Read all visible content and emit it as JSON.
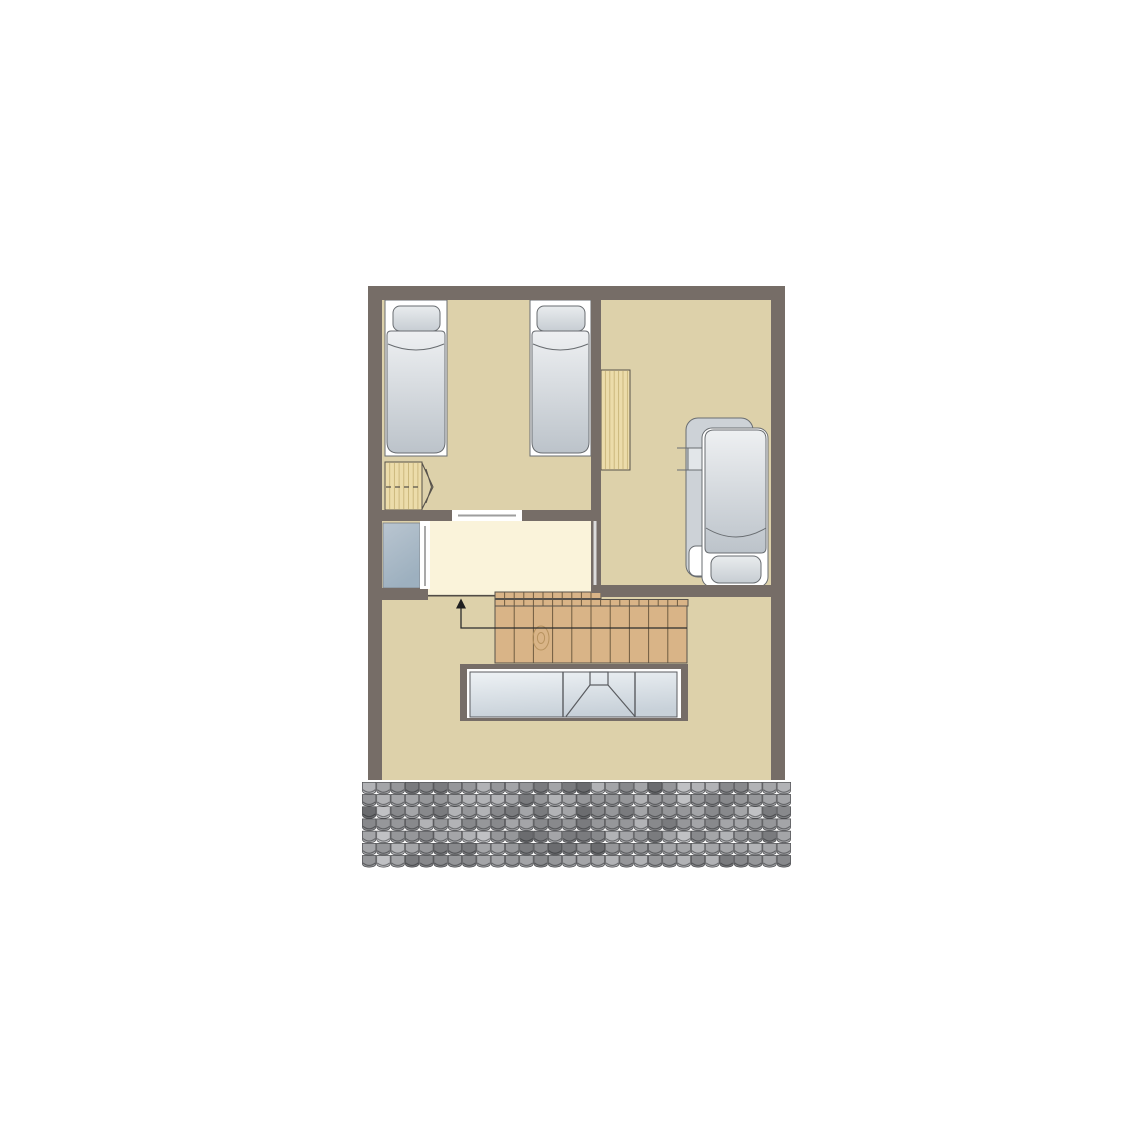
{
  "diagram": {
    "type": "floor-plan",
    "floor": "attic-level",
    "text_labels": []
  },
  "colors": {
    "background": "#ffffff",
    "wall": "#766d67",
    "floor": "#ddd1aa",
    "landing_floor": "#faf3da",
    "bed_recess": "#ffffff",
    "stair_wood": "#d9b487",
    "stair_line": "#6f5c40",
    "light_wood": "#ecdcaa",
    "wood_grain": "#c9b57a",
    "wood_outline": "#57524b",
    "back_bed": "#cdd2d7",
    "shelf_fill": "#e2e6e9",
    "glass_line": "#5a5c60",
    "glass_inset": "#fdfdfd",
    "walk_line": "#2d2d2d",
    "arrow_head": "#1f1f1f",
    "door_line": "#a9a9a9",
    "door_line_light": "#dcdcdc",
    "sliding_door_line": "#9e9e9e",
    "landing_line": "#514c46",
    "knot": "#b8935f",
    "mattress_gradient": [
      "#eef0f2",
      "#bcc3ca"
    ],
    "pillow_gradient": [
      "#e9ecee",
      "#c7cdd3"
    ],
    "closet_gradient": [
      "#b9c5d0",
      "#9db0bf"
    ],
    "glass_gradient": [
      "#eef2f5",
      "#c8d1d9"
    ],
    "tile_palette": [
      "#c0c1c4",
      "#b2b3b6",
      "#a4a5a8",
      "#96979a",
      "#88898c",
      "#7a7b7e",
      "#6b6c6f",
      "#56575a"
    ],
    "tile_gap": "#4a4b4e",
    "tile_shadow": "rgba(35,37,40,0.5)"
  },
  "rooms": [
    {
      "name": "bedroom-left",
      "furniture": [
        "single-bed",
        "single-bed",
        "wardrobe"
      ]
    },
    {
      "name": "bedroom-right",
      "furniture": [
        "desk-shelf",
        "bed",
        "bedside-shelf"
      ]
    },
    {
      "name": "landing",
      "furniture": []
    },
    {
      "name": "closet-niche",
      "furniture": [
        "cabinet"
      ]
    },
    {
      "name": "hall",
      "furniture": [
        "staircase",
        "skylight-void"
      ]
    }
  ],
  "stairs": {
    "direction": "up",
    "treads": 10,
    "tread_step": 19.2,
    "rail_tick_step": 9.6,
    "walk_line_arrow": true
  },
  "skylight": {
    "panes": 3,
    "dormer_in_middle_pane": true
  },
  "roof_tiles": {
    "rows": 7,
    "cols": 30,
    "x": 362,
    "y": 782,
    "tile_w": 14.3,
    "tile_h": 12.2,
    "seed": 20
  }
}
